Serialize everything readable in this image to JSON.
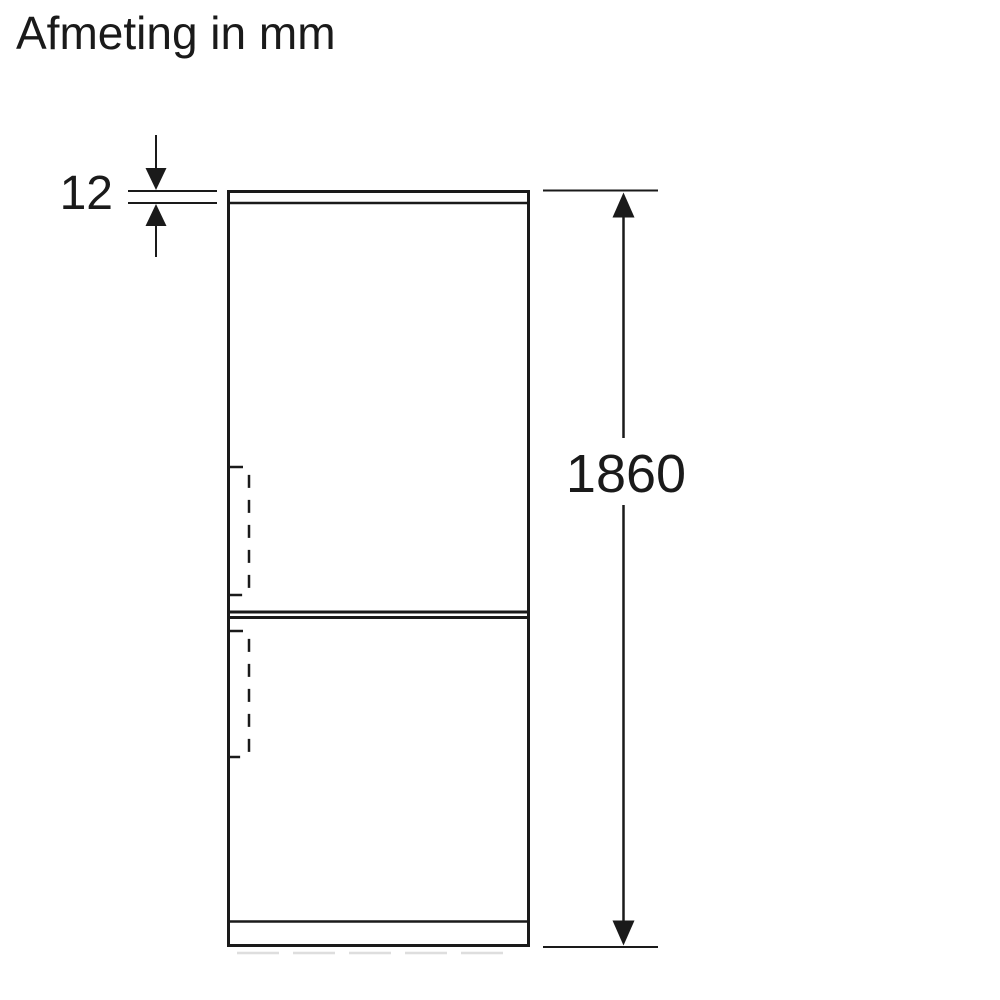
{
  "title": "Afmeting in mm",
  "dimensions": {
    "top_thickness": "12",
    "overall_height": "1860"
  },
  "colors": {
    "line": "#1a1a1a",
    "background": "#ffffff",
    "shadow": "#dedede"
  }
}
